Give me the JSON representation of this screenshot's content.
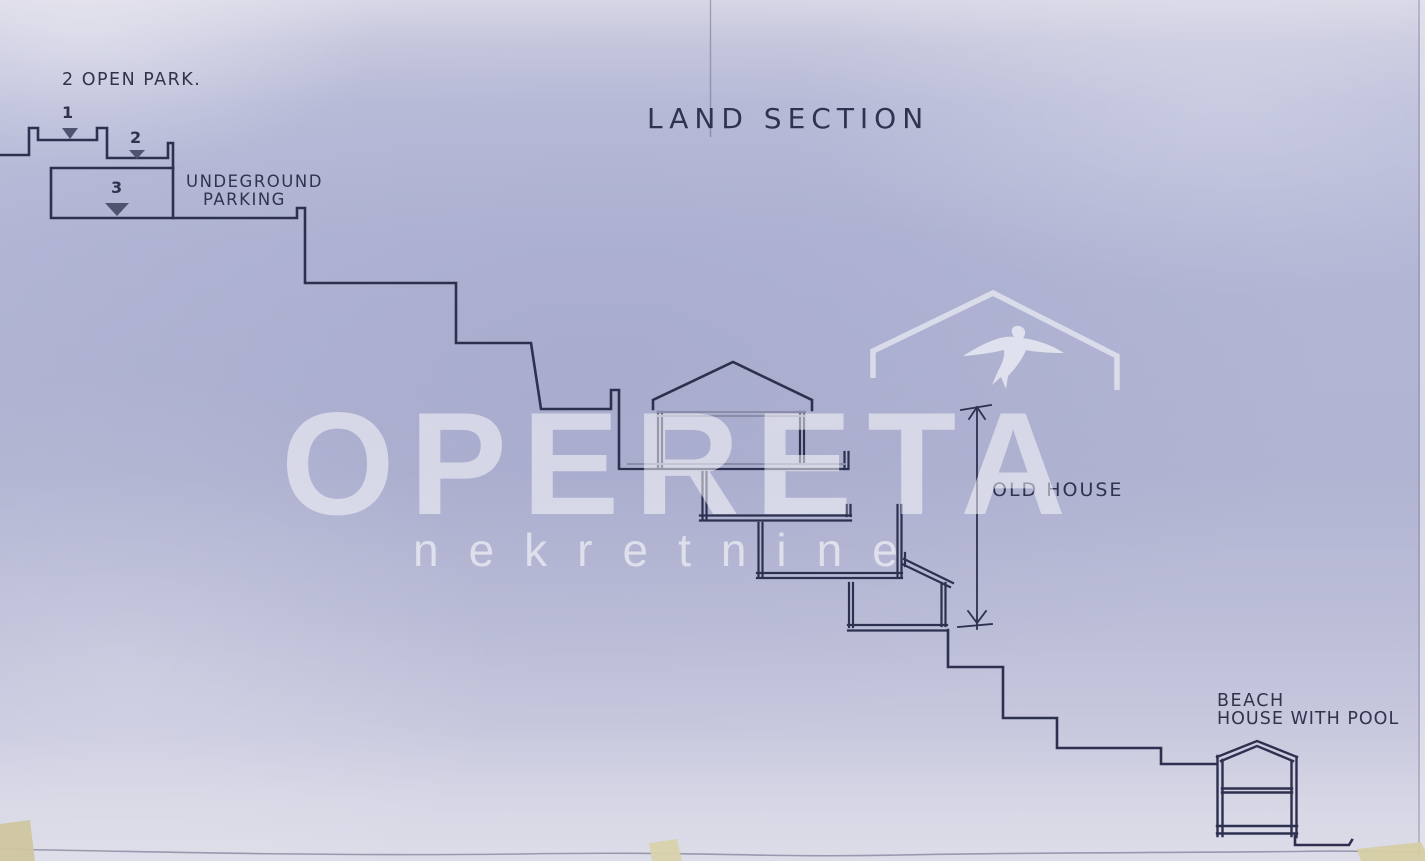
{
  "title": "LAND SECTION",
  "labels": {
    "open_parking_heading": "2 OPEN PARK.",
    "parking_spot_1": "1",
    "parking_spot_2": "2",
    "parking_spot_3": "3",
    "underground_parking_line1": "UNDEGROUND",
    "underground_parking_line2": "PARKING",
    "old_house": "OLD HOUSE",
    "beach_house_line1": "BEACH",
    "beach_house_line2": "HOUSE WITH POOL"
  },
  "watermark": {
    "brand": "OPERETA",
    "tagline": "nekretnine",
    "logo": "roof-swallow-icon"
  },
  "colors": {
    "paper": "#b3b6d5",
    "ink": "#2e3050",
    "pencil": "#8b8da8",
    "watermark_white": "#ffffff",
    "tape": "#d8d0a8"
  }
}
